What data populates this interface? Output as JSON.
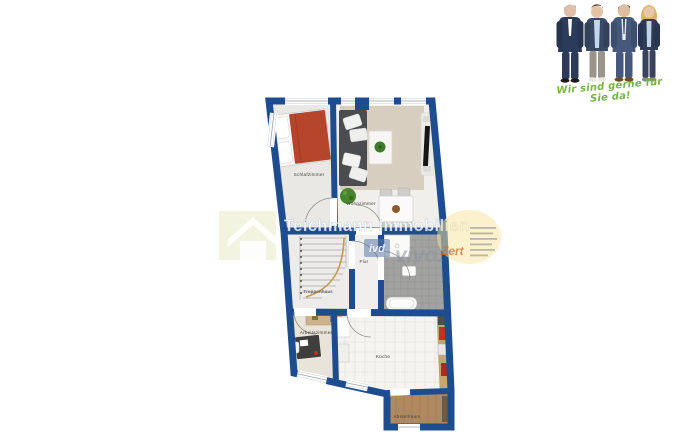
{
  "team_photo": {
    "slogan": "Wir sind gerne für Sie da!",
    "slogan_color": "#76b543",
    "people": "4 team members in business attire"
  },
  "floor_plan": {
    "wall_color": "#1e4d8f",
    "bed_color": "#b5462b",
    "carpet_color": "#d7cec0",
    "rooms": [
      {
        "id": "schlafzimmer",
        "label": "Schlafzimmer"
      },
      {
        "id": "wohnzimmer",
        "label": "Wohnzimmer"
      },
      {
        "id": "flur",
        "label": "Flur"
      },
      {
        "id": "treppenhaus",
        "label": "Treppenhaus"
      },
      {
        "id": "arbeitszimmer",
        "label": "Arbeitszimmer"
      },
      {
        "id": "kueche",
        "label": "Küche"
      },
      {
        "id": "abstellraum",
        "label": "Abstellraum"
      }
    ]
  },
  "watermark": {
    "company": "Teichmann Immobilien",
    "ivd_badge": "ivd",
    "brand": "vivo.",
    "zert": "Zert"
  }
}
